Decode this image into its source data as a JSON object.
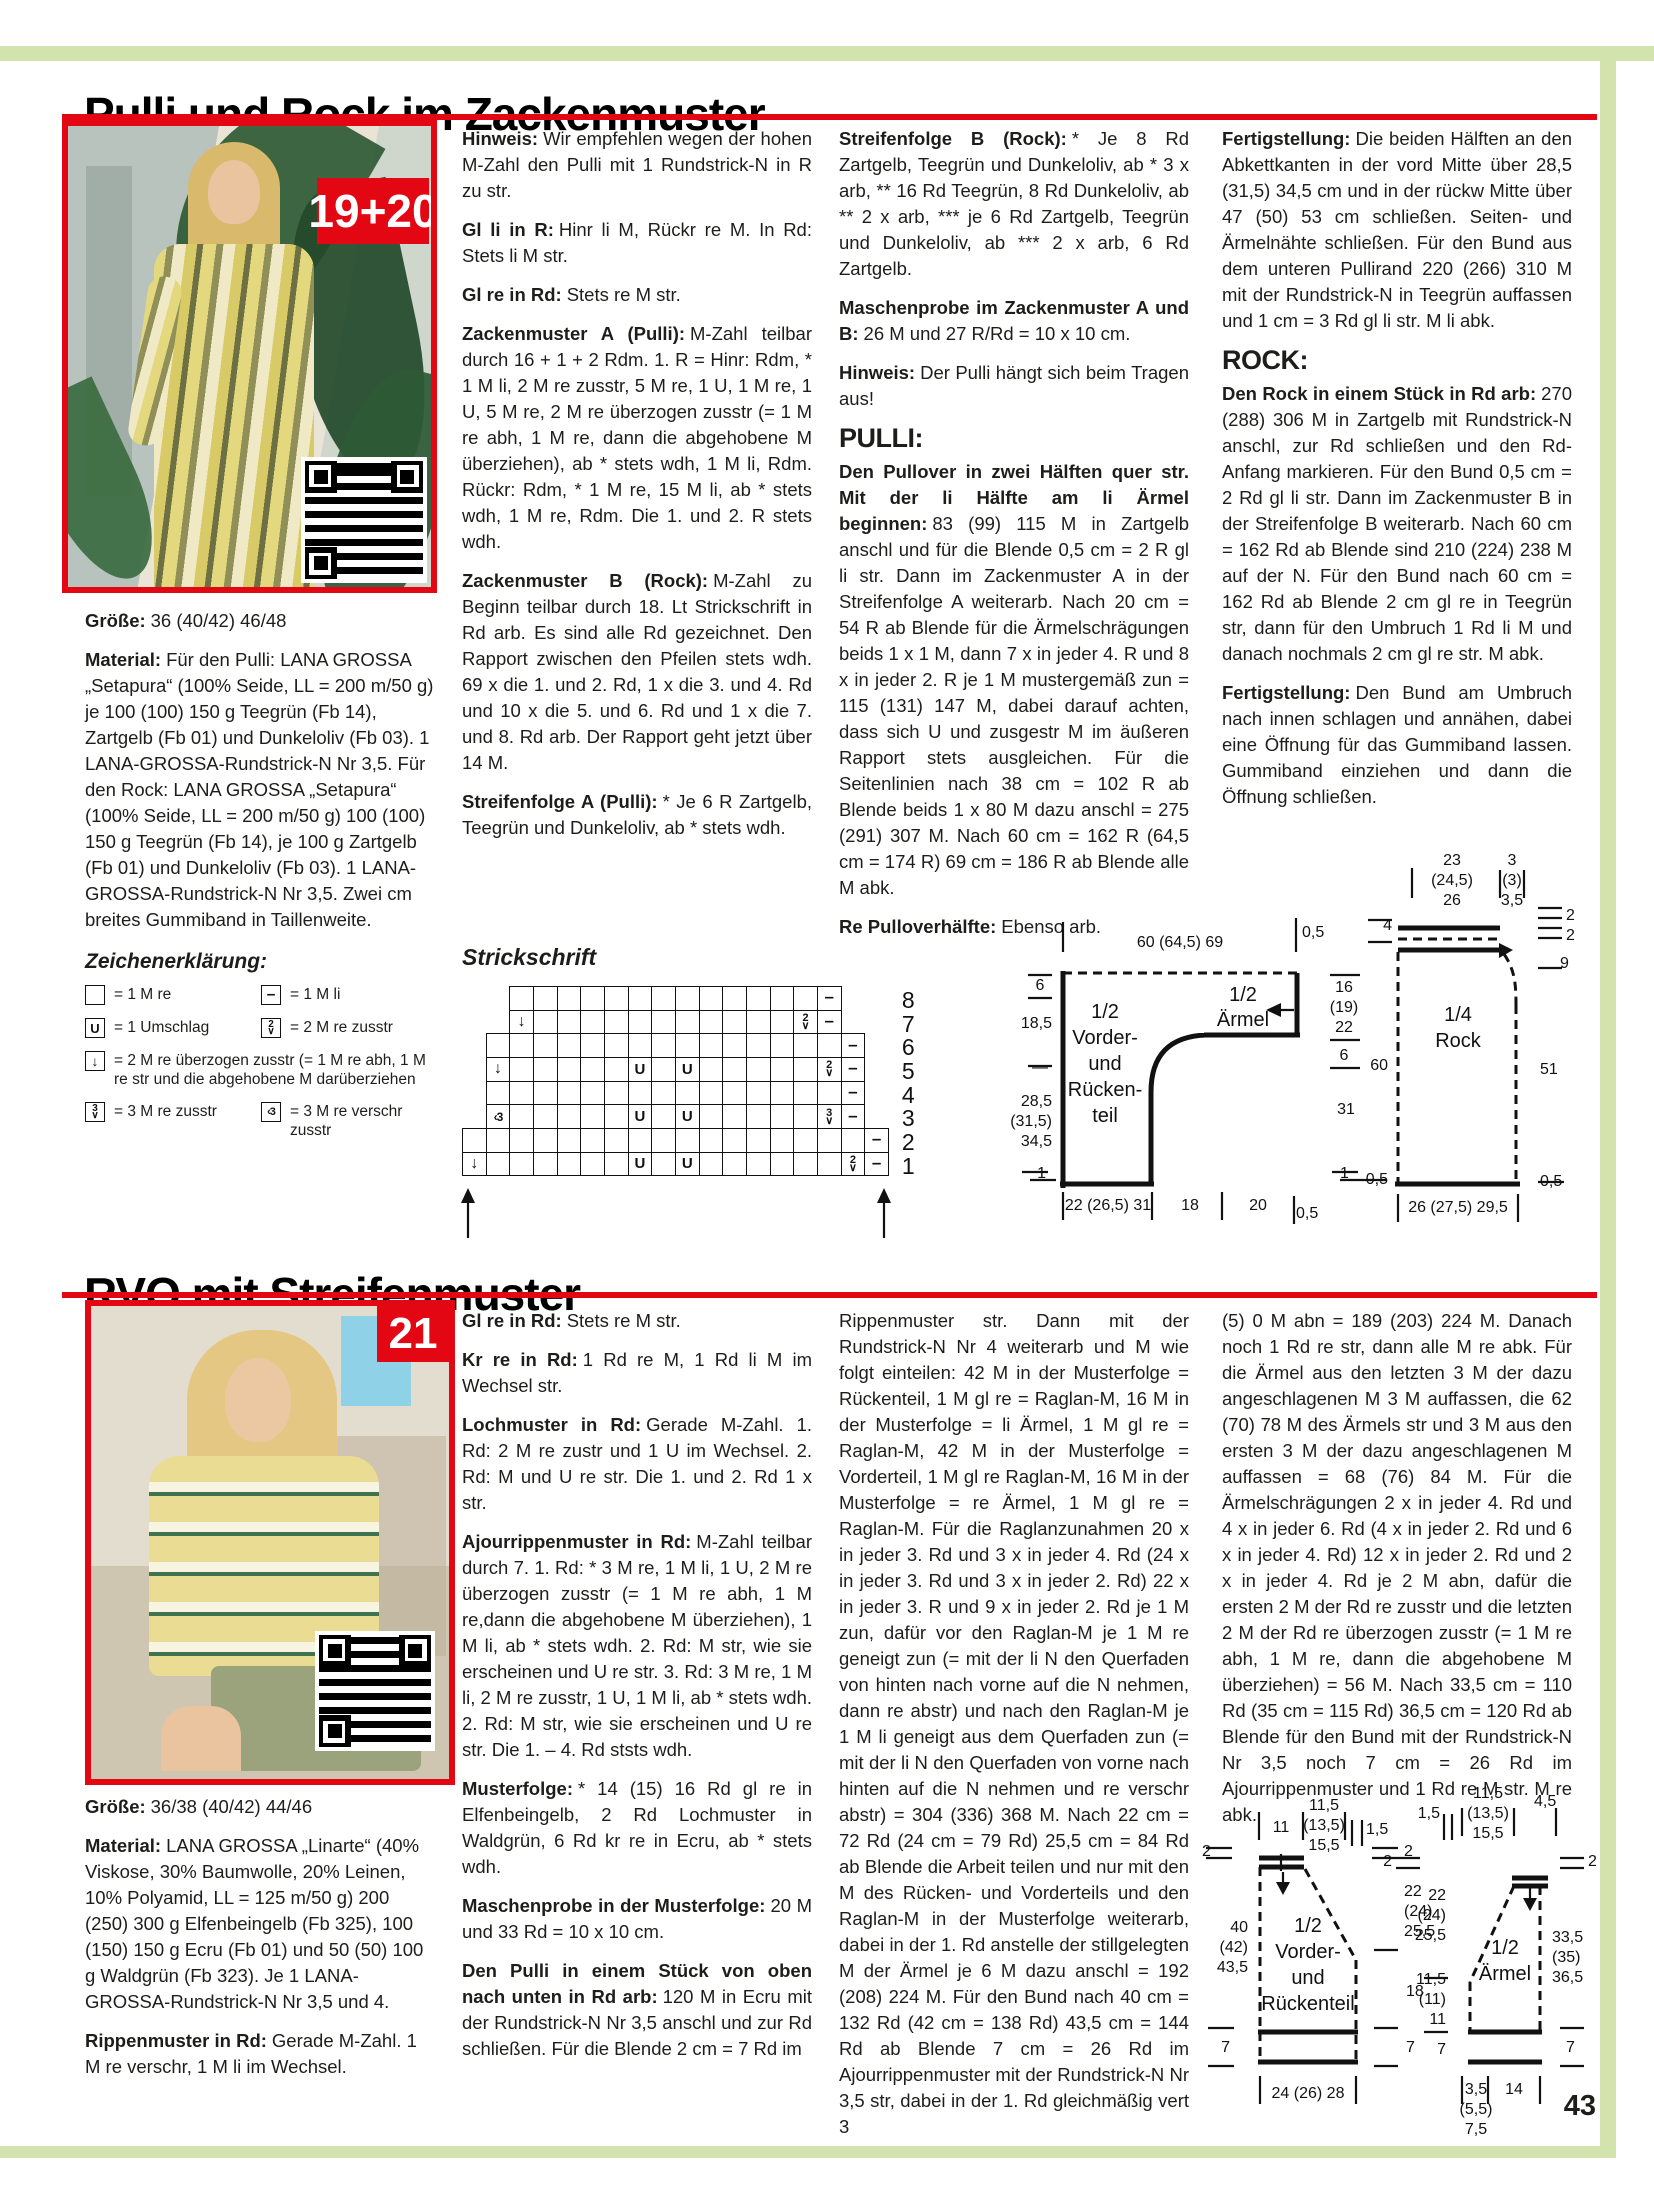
{
  "page": {
    "number": "43",
    "accent_red": "#e30613",
    "accent_green": "#d3e3ae"
  },
  "s1": {
    "title": "Pulli und Rock im Zackenmuster",
    "badge": "19+20",
    "pulli_heading": "PULLI:",
    "rock_heading": "ROCK:",
    "groesse": {
      "b": "Größe:",
      "t": "36 (40/42) 46/48"
    },
    "material": {
      "b": "Material:",
      "t": "Für den Pulli: LANA GROSSA „Setapura“ (100% Seide, LL = 200 m/50 g) je 100 (100) 150 g Teegrün (Fb 14), Zartgelb (Fb 01) und Dunkeloliv (Fb 03). 1 LANA-GROSSA-Rundstrick-N Nr 3,5. Für den Rock: LANA GROSSA „Setapura“ (100% Seide, LL = 200 m/50 g) 100 (100) 150 g Teegrün (Fb 14), je 100 g Zartgelb (Fb 01) und Dunkeloliv (Fb 03). 1 LANA-GROSSA-Rundstrick-N Nr 3,5. Zwei cm breites Gummiband in Taillenweite."
    },
    "legend": {
      "title": "Zeichenerklärung:",
      "items": [
        {
          "sym": "k",
          "text": "= 1 M re",
          "w": false
        },
        {
          "sym": "p",
          "text": "= 1 M li",
          "w": false
        },
        {
          "sym": "yo",
          "text": "= 1 Umschlag",
          "w": false
        },
        {
          "sym": "k2tog",
          "text": "= 2 M re zusstr",
          "w": false
        },
        {
          "sym": "skp",
          "text": "= 2 M re überzogen zusstr (= 1 M re abh, 1 M re str und die abgehobene M darüberziehen",
          "w": true
        },
        {
          "sym": "k3tog",
          "text": "= 3 M re zusstr",
          "w": false
        },
        {
          "sym": "k3tbl",
          "text": "= 3 M re verschr zusstr",
          "w": false
        }
      ]
    },
    "col2": [
      {
        "b": "Hinweis:",
        "t": "Wir empfehlen wegen der hohen M-Zahl den Pulli mit 1 Rundstrick-N in R zu str."
      },
      {
        "b": "Gl li in R:",
        "t": "Hinr li M, Rückr re M. In Rd: Stets li M str."
      },
      {
        "b": "Gl re in Rd:",
        "t": "Stets re M str."
      },
      {
        "b": "Zackenmuster A (Pulli):",
        "t": "M-Zahl teilbar durch 16 + 1 + 2 Rdm. 1. R = Hinr: Rdm, * 1 M li, 2 M re zusstr, 5 M re, 1 U, 1 M re, 1 U, 5 M re, 2 M re überzogen zusstr (= 1 M re abh, 1 M re, dann die abgehobene M überziehen), ab * stets wdh, 1 M li, Rdm. Rückr: Rdm, * 1 M re, 15 M li, ab * stets wdh, 1 M re, Rdm. Die 1. und 2. R stets wdh."
      },
      {
        "b": "Zackenmuster B (Rock):",
        "t": "M-Zahl zu Beginn teilbar durch 18. Lt Strickschrift in Rd arb. Es sind alle Rd gezeichnet. Den Rapport zwischen den Pfeilen stets wdh. 69 x die 1. und 2. Rd, 1 x die 3. und 4. Rd und 10 x die 5. und 6. Rd und 1 x die 7. und 8. Rd arb. Der Rapport geht jetzt über 14 M."
      },
      {
        "b": "Streifenfolge A (Pulli):",
        "t": "* Je 6 R Zartgelb, Teegrün und Dunkeloliv, ab * stets wdh."
      }
    ],
    "chart": {
      "title": "Strickschrift",
      "row_numbers": [
        8,
        7,
        6,
        5,
        4,
        3,
        2,
        1
      ],
      "rows": [
        {
          "n": 8,
          "s": 3,
          "c": [
            "",
            "",
            "",
            "",
            "",
            "",
            "",
            "",
            "",
            "",
            "",
            "",
            "",
            "-"
          ]
        },
        {
          "n": 7,
          "s": 3,
          "c": [
            "A",
            "",
            "",
            "",
            "",
            "",
            "",
            "",
            "",
            "",
            "",
            "",
            "2",
            "-"
          ]
        },
        {
          "n": 6,
          "s": 2,
          "c": [
            "",
            "",
            "",
            "",
            "",
            "",
            "",
            "",
            "",
            "",
            "",
            "",
            "",
            "",
            "",
            "-"
          ]
        },
        {
          "n": 5,
          "s": 2,
          "c": [
            "A",
            "",
            "",
            "",
            "",
            "",
            "U",
            "",
            "U",
            "",
            "",
            "",
            "",
            "",
            "2",
            "-"
          ]
        },
        {
          "n": 4,
          "s": 2,
          "c": [
            "",
            "",
            "",
            "",
            "",
            "",
            "",
            "",
            "",
            "",
            "",
            "",
            "",
            "",
            "",
            "-"
          ]
        },
        {
          "n": 3,
          "s": 2,
          "c": [
            "V",
            "",
            "",
            "",
            "",
            "",
            "U",
            "",
            "U",
            "",
            "",
            "",
            "",
            "",
            "3",
            "-"
          ]
        },
        {
          "n": 2,
          "s": 1,
          "c": [
            "",
            "",
            "",
            "",
            "",
            "",
            "",
            "",
            "",
            "",
            "",
            "",
            "",
            "",
            "",
            "",
            "",
            "-"
          ]
        },
        {
          "n": 1,
          "s": 1,
          "c": [
            "A",
            "",
            "",
            "",
            "",
            "",
            "",
            "U",
            "",
            "U",
            "",
            "",
            "",
            "",
            "",
            "",
            "2",
            "-"
          ]
        }
      ]
    },
    "col3": [
      {
        "b": "Streifenfolge B (Rock):",
        "t": "* Je 8 Rd Zartgelb, Teegrün und Dunkeloliv, ab * 3 x arb, ** 16 Rd Teegrün, 8 Rd Dunkeloliv, ab ** 2 x arb, *** je 6 Rd Zartgelb, Teegrün und Dunkeloliv, ab *** 2 x arb, 6 Rd Zartgelb."
      },
      {
        "b": "Maschenprobe im Zackenmuster A und B:",
        "t": "26 M und 27 R/Rd = 10 x 10 cm."
      },
      {
        "b": "Hinweis:",
        "t": "Der Pulli hängt sich beim Tragen aus!"
      },
      {
        "b": "Den Pullover in zwei Hälften quer str. Mit der li Hälfte am li Ärmel beginnen:",
        "t": "83 (99) 115 M in Zartgelb anschl und für die Blende 0,5 cm = 2 R gl li str. Dann im Zackenmuster A in der Streifenfolge A weiterarb. Nach 20 cm = 54 R ab Blende für die Ärmelschrägungen beids 1 x 1 M, dann 7 x in jeder 4. R und 8 x in jeder 2. R je 1 M mustergemäß zun = 115 (131) 147 M, dabei darauf achten, dass sich U und zusgestr M im äußeren Rapport stets ausgleichen. Für die Seitenlinien nach 38 cm = 102 R ab Blende beids 1 x 80 M dazu anschl = 275 (291) 307 M. Nach 60 cm = 162 R (64,5 cm = 174 R) 69 cm = 186 R ab Blende alle M abk."
      },
      {
        "b": "Re Pulloverhälfte:",
        "t": "Ebenso arb."
      }
    ],
    "col4": [
      {
        "b": "Fertigstellung:",
        "t": "Die beiden Hälften an den Abkettkanten in der vord Mitte über 28,5 (31,5) 34,5 cm und in der rückw Mitte über 47 (50) 53 cm schließen. Seiten- und Ärmelnähte schließen. Für den Bund aus dem unteren Pullirand 220 (266) 310 M mit der Rundstrick-N in Teegrün auffassen und 1 cm = 3 Rd gl li str. M li abk."
      },
      {
        "b": "Den Rock in einem Stück in Rd arb:",
        "t": "270 (288) 306 M in Zartgelb mit Rundstrick-N anschl, zur Rd schließen und den Rd-Anfang markieren. Für den Bund 0,5 cm = 2 Rd gl li str. Dann im Zackenmuster B in der Streifenfolge B weiterarb. Nach 60 cm = 162 Rd ab Blende sind 210 (224) 238 M auf der N. Für den Bund nach 60 cm = 162 Rd ab Blende 2 cm gl re in Teegrün str, dann für den Umbruch 1 Rd li M und danach nochmals 2 cm gl re str. M abk."
      },
      {
        "b": "Fertigstellung:",
        "t": "Den Bund am Umbruch nach innen schlagen und annähen, dabei eine Öffnung für das Gummiband lassen. Gummiband einziehen und dann die Öffnung schließen."
      }
    ]
  },
  "s2": {
    "title": "RVO mit Streifenmuster",
    "badge": "21",
    "groesse": {
      "b": "Größe:",
      "t": "36/38 (40/42) 44/46"
    },
    "material": {
      "b": "Material:",
      "t": "LANA GROSSA „Linarte“ (40% Viskose, 30% Baumwolle, 20% Leinen, 10% Polyamid, LL = 125 m/50 g) 200 (250) 300 g Elfenbeingelb (Fb 325), 100 (150) 150 g Ecru (Fb 01) und 50 (50) 100 g Waldgrün (Fb 323). Je 1 LANA-GROSSA-Rundstrick-N Nr 3,5 und 4."
    },
    "rippen": {
      "b": "Rippenmuster in Rd:",
      "t": "Gerade M-Zahl. 1 M re verschr, 1 M li im Wechsel."
    },
    "col2": [
      {
        "b": "Gl re in Rd:",
        "t": "Stets re M str."
      },
      {
        "b": "Kr re in Rd:",
        "t": "1 Rd re M, 1 Rd li M im Wechsel str."
      },
      {
        "b": "Lochmuster in Rd:",
        "t": "Gerade M-Zahl. 1. Rd: 2 M re zustr und 1 U im Wechsel. 2. Rd: M und U re str. Die 1. und 2. Rd 1 x str."
      },
      {
        "b": "Ajourrippenmuster in Rd:",
        "t": "M-Zahl teilbar durch 7. 1. Rd: * 3 M re, 1 M li, 1 U, 2 M re überzogen zusstr (= 1 M re abh, 1 M re,dann die abgehobene M überziehen), 1 M li, ab * stets wdh. 2. Rd: M str, wie sie erscheinen und U re str. 3. Rd: 3 M re, 1 M li, 2 M re zusstr, 1 U, 1 M li, ab * stets wdh. 2. Rd: M str, wie sie erscheinen und U re str. Die 1. – 4. Rd ststs wdh."
      },
      {
        "b": "Musterfolge:",
        "t": "* 14 (15) 16 Rd gl re in Elfenbeingelb, 2 Rd Lochmuster in Waldgrün, 6 Rd kr re in Ecru, ab * stets wdh."
      },
      {
        "b": "Maschenprobe in der Musterfolge:",
        "t": "20 M und 33 Rd = 10 x 10 cm."
      },
      {
        "b": "Den Pulli in einem Stück von oben nach unten in Rd arb:",
        "t": "120 M in Ecru mit der Rundstrick-N Nr 3,5 anschl und zur Rd schließen. Für die Blende 2 cm = 7 Rd im"
      }
    ],
    "col3": "Rippenmuster str. Dann mit der Rundstrick-N Nr 4 weiterarb und M wie folgt einteilen: 42 M in der Musterfolge = Rückenteil, 1 M gl re = Raglan-M, 16 M in der Musterfolge = li Ärmel, 1 M gl re = Raglan-M, 42 M in der Musterfolge = Vorderteil, 1 M gl re Raglan-M, 16 M in der Musterfolge = re Ärmel, 1 M gl re = Raglan-M. Für die Raglanzunahmen 20 x in jeder 3. Rd und 3 x in jeder 4. Rd (24 x in jeder 3. Rd und 3 x in jeder 2. Rd) 22 x in jeder 3. R und 9 x in jeder 2. Rd je 1 M zun, dafür vor den Raglan-M je 1 M re geneigt zun (= mit der li N den Querfaden von hinten nach vorne auf die N nehmen, dann re abstr) und nach den Raglan-M je 1 M li geneigt aus dem Querfaden zun (= mit der li N den Querfaden von vorne nach hinten auf die N nehmen und re verschr abstr) = 304 (336) 368 M. Nach 22 cm = 72 Rd (24 cm = 79 Rd) 25,5 cm = 84 Rd ab Blende die Arbeit teilen und nur mit den M des Rücken- und Vorderteils und den Raglan-M in der Musterfolge weiterarb, dabei in der 1. Rd anstelle der stillgelegten M der Ärmel je 6 M dazu anschl = 192 (208) 224 M. Für den Bund nach 40 cm = 132 Rd (42 cm = 138 Rd) 43,5 cm = 144 Rd ab Blende 7 cm = 26 Rd im Ajourrippenmuster mit der Rundstrick-N Nr 3,5 str, dabei in der 1. Rd gleichmäßig vert 3",
    "col4": "(5) 0 M abn = 189 (203) 224 M. Danach noch 1 Rd re str, dann alle M re abk. Für die Ärmel aus den letzten 3 M der dazu angeschlagenen M 3 M auffassen, die 62 (70) 78 M des Ärmels str und 3 M aus den ersten 3 M der dazu angeschlagenen M auffassen = 68 (76) 84 M. Für die Ärmelschrägungen 2 x in jeder 4. Rd und 4 x in jeder 6. Rd (4 x in jeder 2. Rd und 6 x in jeder 4. Rd) 12 x in jeder 2. Rd und 2 x in jeder 4. Rd je 2 M abn, dafür die ersten 2 M der Rd re zusstr und die letzten 2 M der Rd re überzogen zusstr (= 1 M re abh, 1 M re, dann die abgehobene M überziehen) = 56 M. Nach 33,5 cm = 110 Rd (35 cm = 115 Rd) 36,5 cm = 120 Rd ab Blende für den Bund mit der Rundstrick-N Nr 3,5 noch 7 cm = 26 Rd im Ajourrippenmuster und 1 Rd re M str. M re abk."
  },
  "diagram_labels": [
    {
      "t": "60 (64,5) 69",
      "x": 1180,
      "y": 935,
      "a": "c"
    },
    {
      "t": "0,5",
      "x": 1302,
      "y": 925
    },
    {
      "t": "6",
      "x": 1040,
      "y": 978,
      "a": "c"
    },
    {
      "t": "18,5",
      "x": 1052,
      "y": 1016,
      "a": "r"
    },
    {
      "t": "—",
      "x": 1040,
      "y": 1060,
      "a": "c"
    },
    {
      "t": "28,5",
      "x": 1052,
      "y": 1094,
      "a": "r"
    },
    {
      "t": "(31,5)",
      "x": 1052,
      "y": 1114,
      "a": "r"
    },
    {
      "t": "34,5",
      "x": 1052,
      "y": 1134,
      "a": "r"
    },
    {
      "t": "1",
      "x": 1046,
      "y": 1166,
      "a": "r"
    },
    {
      "t": "1/2",
      "x": 1105,
      "y": 1002,
      "a": "c",
      "fs": 20
    },
    {
      "t": "Vorder-",
      "x": 1105,
      "y": 1028,
      "a": "c",
      "fs": 20
    },
    {
      "t": "und",
      "x": 1105,
      "y": 1054,
      "a": "c",
      "fs": 20
    },
    {
      "t": "Rücken-",
      "x": 1105,
      "y": 1080,
      "a": "c",
      "fs": 20
    },
    {
      "t": "teil",
      "x": 1105,
      "y": 1106,
      "a": "c",
      "fs": 20
    },
    {
      "t": "1/2",
      "x": 1243,
      "y": 985,
      "a": "c",
      "fs": 20
    },
    {
      "t": "Ärmel",
      "x": 1243,
      "y": 1010,
      "a": "c",
      "fs": 20
    },
    {
      "t": "16",
      "x": 1344,
      "y": 980,
      "a": "c"
    },
    {
      "t": "(19)",
      "x": 1344,
      "y": 1000,
      "a": "c"
    },
    {
      "t": "22",
      "x": 1344,
      "y": 1020,
      "a": "c"
    },
    {
      "t": "6",
      "x": 1344,
      "y": 1048,
      "a": "c"
    },
    {
      "t": "31",
      "x": 1346,
      "y": 1102,
      "a": "c"
    },
    {
      "t": "1",
      "x": 1340,
      "y": 1166
    },
    {
      "t": "22 (26,5) 31",
      "x": 1108,
      "y": 1198,
      "a": "c"
    },
    {
      "t": "18",
      "x": 1190,
      "y": 1198,
      "a": "c"
    },
    {
      "t": "20",
      "x": 1258,
      "y": 1198,
      "a": "c"
    },
    {
      "t": "0,5",
      "x": 1296,
      "y": 1206
    },
    {
      "t": "23",
      "x": 1452,
      "y": 853,
      "a": "c"
    },
    {
      "t": "(24,5)",
      "x": 1452,
      "y": 873,
      "a": "c"
    },
    {
      "t": "26",
      "x": 1452,
      "y": 893,
      "a": "c"
    },
    {
      "t": "3",
      "x": 1512,
      "y": 853,
      "a": "c"
    },
    {
      "t": "(3)",
      "x": 1512,
      "y": 873,
      "a": "c"
    },
    {
      "t": "3,5",
      "x": 1512,
      "y": 893,
      "a": "c"
    },
    {
      "t": "4",
      "x": 1392,
      "y": 918,
      "a": "r"
    },
    {
      "t": "2",
      "x": 1566,
      "y": 908
    },
    {
      "t": "2",
      "x": 1566,
      "y": 928
    },
    {
      "t": "9",
      "x": 1560,
      "y": 956
    },
    {
      "t": "1/4",
      "x": 1458,
      "y": 1005,
      "a": "c",
      "fs": 20
    },
    {
      "t": "Rock",
      "x": 1458,
      "y": 1031,
      "a": "c",
      "fs": 20
    },
    {
      "t": "60",
      "x": 1388,
      "y": 1058,
      "a": "r"
    },
    {
      "t": "51",
      "x": 1540,
      "y": 1062
    },
    {
      "t": "0,5",
      "x": 1388,
      "y": 1172,
      "a": "r"
    },
    {
      "t": "0,5",
      "x": 1540,
      "y": 1174
    },
    {
      "t": "26 (27,5) 29,5",
      "x": 1458,
      "y": 1200,
      "a": "c"
    },
    {
      "t": "11",
      "x": 1281,
      "y": 1820,
      "a": "c"
    },
    {
      "t": "11,5",
      "x": 1324,
      "y": 1798,
      "a": "c"
    },
    {
      "t": "(13,5)",
      "x": 1324,
      "y": 1818,
      "a": "c"
    },
    {
      "t": "15,5",
      "x": 1324,
      "y": 1838,
      "a": "c"
    },
    {
      "t": "1,5",
      "x": 1366,
      "y": 1822
    },
    {
      "t": "2",
      "x": 1202,
      "y": 1844
    },
    {
      "t": "40",
      "x": 1248,
      "y": 1920,
      "a": "r"
    },
    {
      "t": "(42)",
      "x": 1248,
      "y": 1940,
      "a": "r"
    },
    {
      "t": "43,5",
      "x": 1248,
      "y": 1960,
      "a": "r"
    },
    {
      "t": "7",
      "x": 1230,
      "y": 2040,
      "a": "r"
    },
    {
      "t": "1/2",
      "x": 1308,
      "y": 1916,
      "a": "c",
      "fs": 20
    },
    {
      "t": "Vorder-",
      "x": 1308,
      "y": 1942,
      "a": "c",
      "fs": 20
    },
    {
      "t": "und",
      "x": 1308,
      "y": 1968,
      "a": "c",
      "fs": 20
    },
    {
      "t": "Rückenteil",
      "x": 1308,
      "y": 1994,
      "a": "c",
      "fs": 20
    },
    {
      "t": "2",
      "x": 1404,
      "y": 1844
    },
    {
      "t": "22",
      "x": 1404,
      "y": 1884
    },
    {
      "t": "(24)",
      "x": 1404,
      "y": 1904
    },
    {
      "t": "25,5",
      "x": 1404,
      "y": 1924
    },
    {
      "t": "18",
      "x": 1406,
      "y": 1984
    },
    {
      "t": "7",
      "x": 1406,
      "y": 2040
    },
    {
      "t": "24 (26) 28",
      "x": 1308,
      "y": 2086,
      "a": "c"
    },
    {
      "t": "1,5",
      "x": 1440,
      "y": 1806,
      "a": "r"
    },
    {
      "t": "11,5",
      "x": 1488,
      "y": 1786,
      "a": "c"
    },
    {
      "t": "(13,5)",
      "x": 1488,
      "y": 1806,
      "a": "c"
    },
    {
      "t": "15,5",
      "x": 1488,
      "y": 1826,
      "a": "c"
    },
    {
      "t": "4,5",
      "x": 1534,
      "y": 1794
    },
    {
      "t": "2",
      "x": 1392,
      "y": 1854,
      "a": "r"
    },
    {
      "t": "22",
      "x": 1446,
      "y": 1888,
      "a": "r"
    },
    {
      "t": "(24)",
      "x": 1446,
      "y": 1908,
      "a": "r"
    },
    {
      "t": "25,5",
      "x": 1446,
      "y": 1928,
      "a": "r"
    },
    {
      "t": "11,5",
      "x": 1446,
      "y": 1972,
      "a": "r"
    },
    {
      "t": "(11)",
      "x": 1446,
      "y": 1992,
      "a": "r"
    },
    {
      "t": "11",
      "x": 1446,
      "y": 2012,
      "a": "r"
    },
    {
      "t": "7",
      "x": 1446,
      "y": 2042,
      "a": "r"
    },
    {
      "t": "1/2",
      "x": 1505,
      "y": 1938,
      "a": "c",
      "fs": 20
    },
    {
      "t": "Ärmel",
      "x": 1505,
      "y": 1964,
      "a": "c",
      "fs": 20
    },
    {
      "t": "2",
      "x": 1588,
      "y": 1854
    },
    {
      "t": "33,5",
      "x": 1552,
      "y": 1930
    },
    {
      "t": "(35)",
      "x": 1552,
      "y": 1950
    },
    {
      "t": "36,5",
      "x": 1552,
      "y": 1970
    },
    {
      "t": "7",
      "x": 1566,
      "y": 2040
    },
    {
      "t": "3,5",
      "x": 1476,
      "y": 2082,
      "a": "c"
    },
    {
      "t": "(5,5)",
      "x": 1476,
      "y": 2102,
      "a": "c"
    },
    {
      "t": "7,5",
      "x": 1476,
      "y": 2122,
      "a": "c"
    },
    {
      "t": "14",
      "x": 1514,
      "y": 2082,
      "a": "c"
    }
  ]
}
